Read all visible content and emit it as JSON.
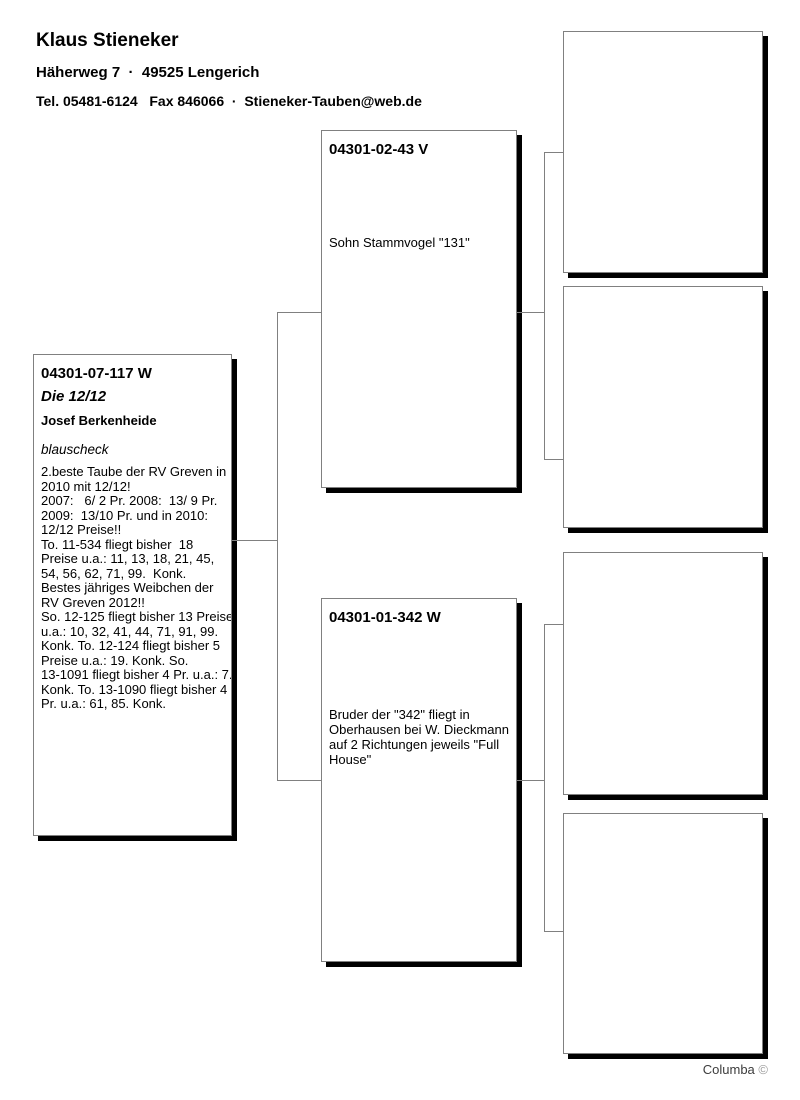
{
  "header": {
    "name": "Klaus Stieneker",
    "address": "Häherweg 7  ·  49525 Lengerich",
    "contact": "Tel. 05481-6124   Fax 846066  ·  Stieneker-Tauben@web.de"
  },
  "pedigree": {
    "subject": {
      "ring": "04301-07-117 W",
      "nickname": "Die 12/12",
      "breeder": "Josef Berkenheide",
      "color": "blauscheck",
      "description": "2.beste Taube der RV Greven in\n2010 mit 12/12!\n2007:   6/ 2 Pr. 2008:  13/ 9 Pr.\n2009:  13/10 Pr. und in 2010:\n12/12 Preise!!\nTo. 11-534 fliegt bisher  18\nPreise u.a.: 11, 13, 18, 21, 45,\n54, 56, 62, 71, 99.  Konk.\nBestes jähriges Weibchen der\nRV Greven 2012!!\nSo. 12-125 fliegt bisher 13 Preise\nu.a.: 10, 32, 41, 44, 71, 91, 99.\nKonk. To. 12-124 fliegt bisher 5\nPreise u.a.: 19. Konk. So.\n13-1091 fliegt bisher 4 Pr. u.a.: 7.\nKonk. To. 13-1090 fliegt bisher 4\nPr. u.a.: 61, 85. Konk."
    },
    "father": {
      "ring": "04301-02-43 V",
      "note": "Sohn Stammvogel \"131\""
    },
    "mother": {
      "ring": "04301-01-342 W",
      "note": "Bruder der \"342\" fliegt in\nOberhausen bei W. Dieckmann\nauf 2 Richtungen jeweils \"Full\nHouse\""
    }
  },
  "footer": {
    "brand": "Columba",
    "copyright": "©"
  },
  "colors": {
    "line": "#808080",
    "box_border": "#808080",
    "box_shadow": "#000000"
  }
}
